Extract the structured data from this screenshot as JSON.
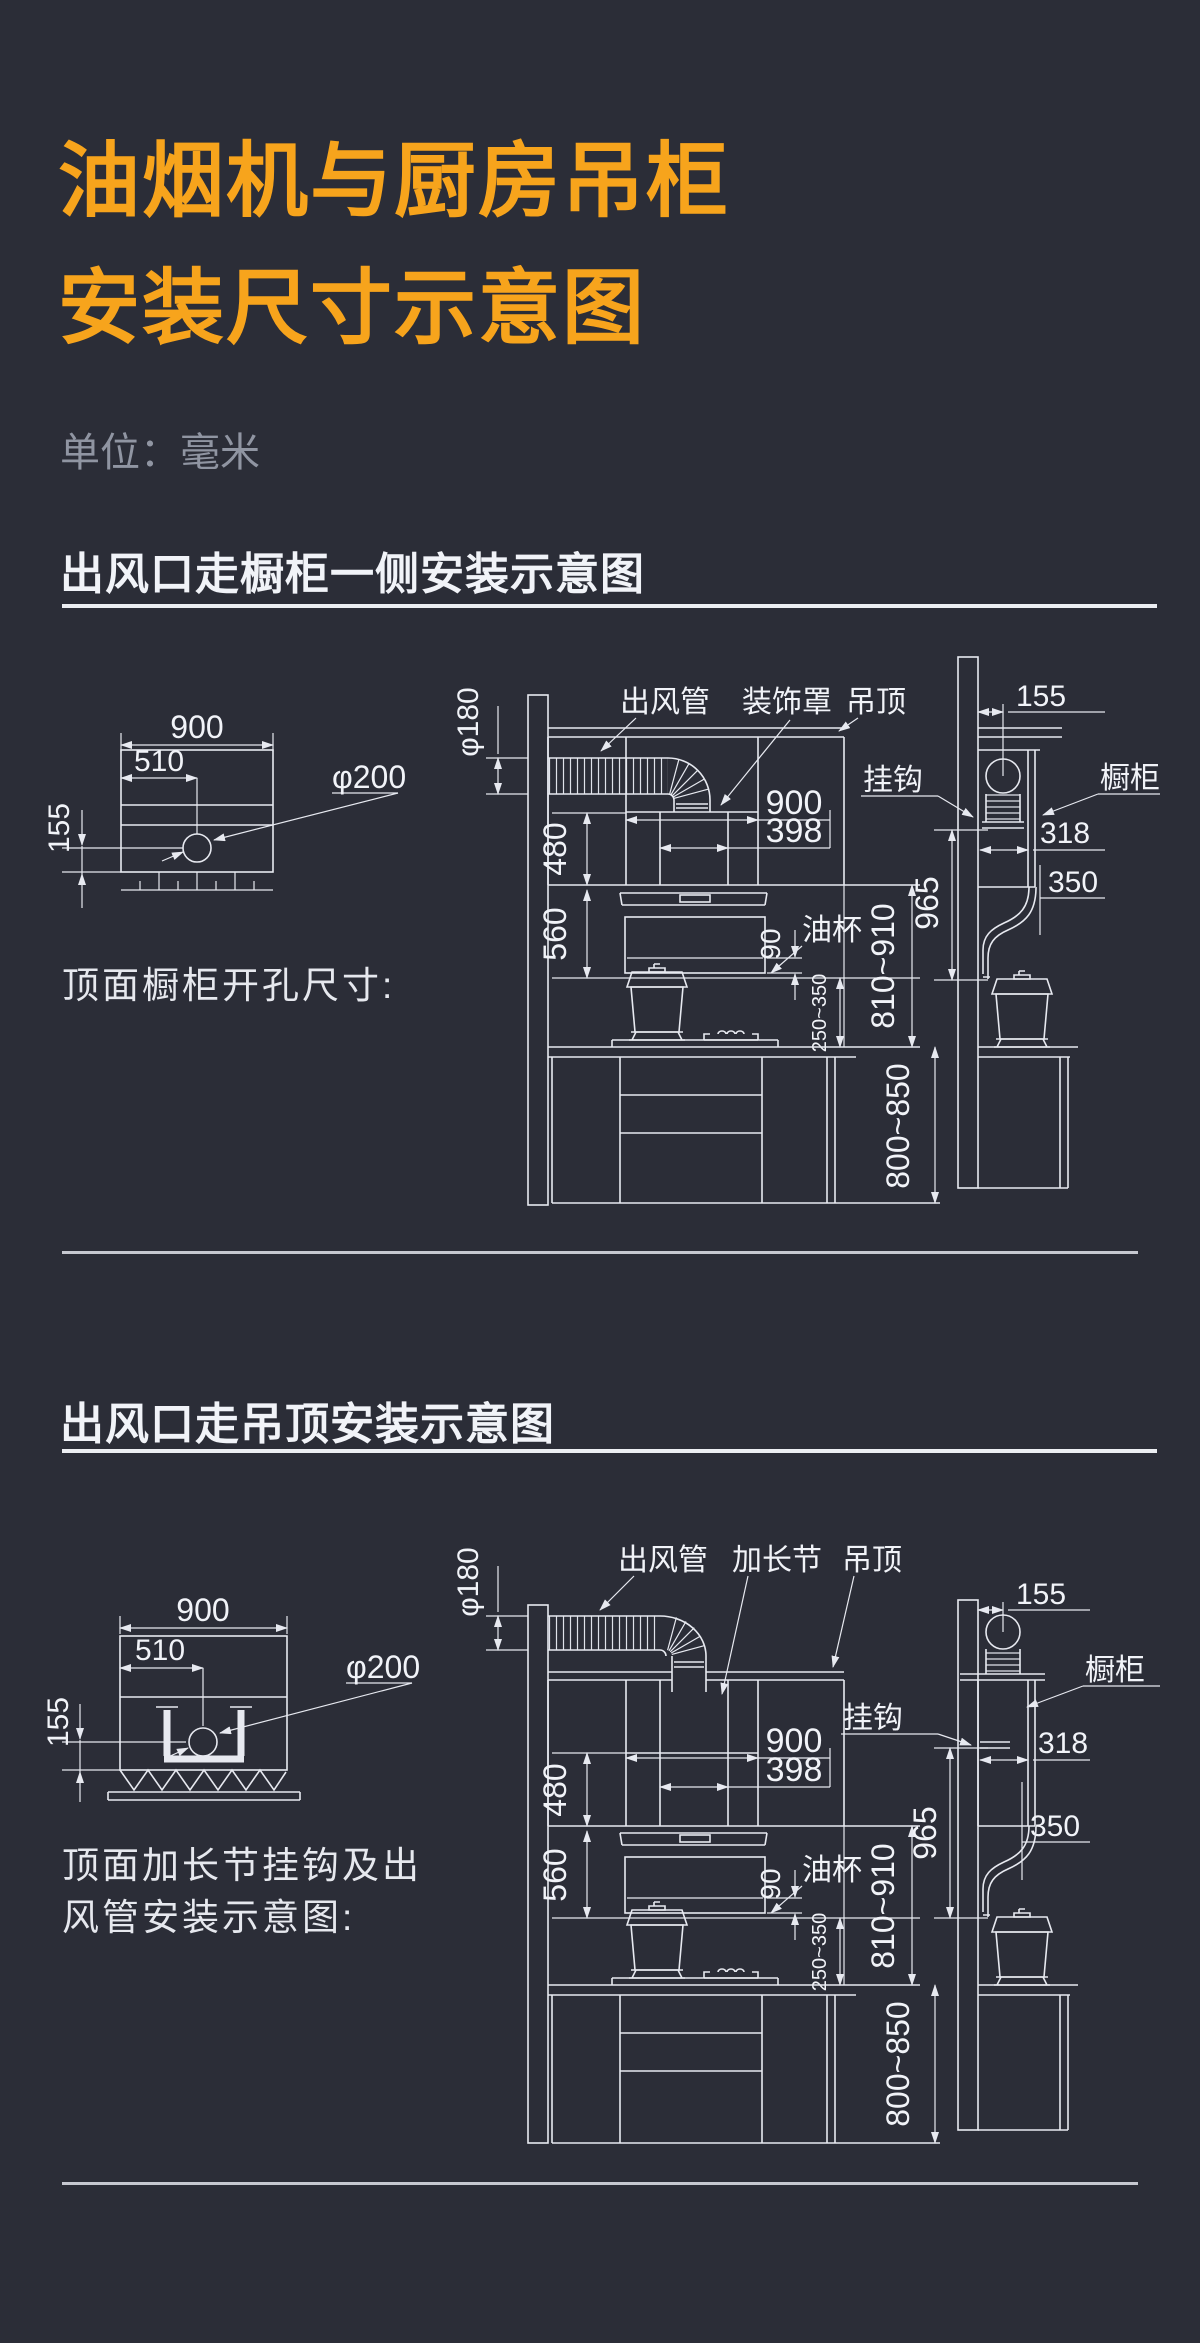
{
  "colors": {
    "background": "#2b2d37",
    "accent_orange": "#f7a41c",
    "line": "#e7e9f0",
    "text": "#f1f3f8",
    "muted_gray": "#9095a2",
    "divider": "#c6c8d0"
  },
  "header": {
    "title_line1": "油烟机与厨房吊柜",
    "title_line2": "安装尺寸示意图",
    "unit_label": "单位：毫米"
  },
  "section_cabinet_side": {
    "heading": "出风口走橱柜一侧安装示意图",
    "caption": "顶面橱柜开孔尺寸:",
    "labels": {
      "duct": "出风管",
      "decor_cover": "装饰罩",
      "ceiling": "吊顶",
      "hook": "挂钩",
      "cabinet": "橱柜",
      "oil_cup": "油杯"
    },
    "dims": {
      "opening_width": "900",
      "opening_center_offset": "510",
      "opening_front_offset": "155",
      "opening_dia": "φ200",
      "duct_dia": "φ180",
      "hood_width": "900",
      "cover_width": "398",
      "cover_height": "480",
      "hood_height": "560",
      "oil_cup_height": "90",
      "wall_offset": "155",
      "cabinet_opening_depth": "318",
      "cabinet_depth": "350",
      "hook_height": "965",
      "hood_to_counter": "810~910",
      "hood_clearance": "250~350",
      "counter_height": "800~850"
    }
  },
  "section_ceiling": {
    "heading": "出风口走吊顶安装示意图",
    "caption_line1": "顶面加长节挂钩及出",
    "caption_line2": "风管安装示意图:",
    "labels": {
      "duct": "出风管",
      "extension": "加长节",
      "ceiling": "吊顶",
      "hook": "挂钩",
      "cabinet": "橱柜",
      "oil_cup": "油杯"
    },
    "dims": {
      "opening_width": "900",
      "opening_center_offset": "510",
      "opening_front_offset": "155",
      "opening_dia": "φ200",
      "duct_dia": "φ180",
      "hood_width": "900",
      "cover_width": "398",
      "cover_height": "480",
      "hood_height": "560",
      "oil_cup_height": "90",
      "wall_offset": "155",
      "cabinet_opening_depth": "318",
      "cabinet_depth": "350",
      "hook_height": "965",
      "hood_to_counter": "810~910",
      "hood_clearance": "250~350",
      "counter_height": "800~850"
    }
  }
}
